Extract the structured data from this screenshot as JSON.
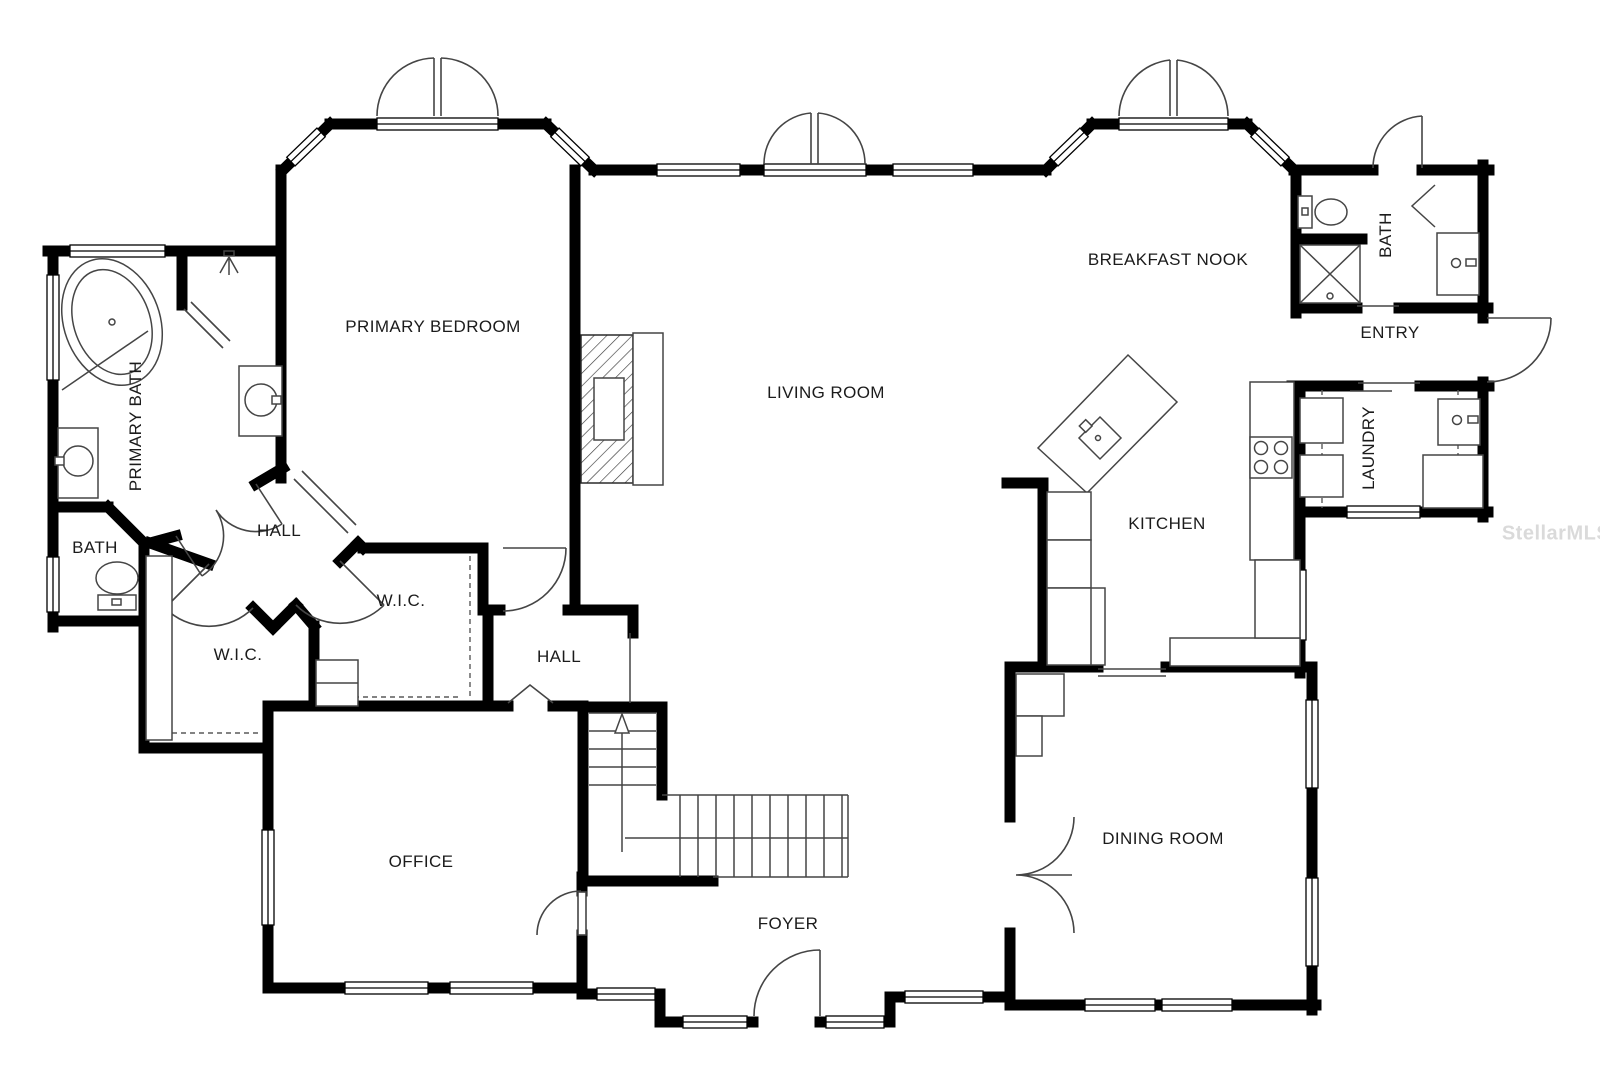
{
  "rooms": {
    "primary_bedroom": "PRIMARY BEDROOM",
    "primary_bath": "PRIMARY BATH",
    "bath_left": "BATH",
    "hall_main": "HALL",
    "wic_left": "W.I.C.",
    "wic_right": "W.I.C.",
    "hall_right": "HALL",
    "office": "OFFICE",
    "foyer": "FOYER",
    "living_room": "LIVING ROOM",
    "breakfast_nook": "BREAKFAST NOOK",
    "entry": "ENTRY",
    "bath_pool": "BATH",
    "laundry": "LAUNDRY",
    "kitchen": "KITCHEN",
    "dining_room": "DINING ROOM"
  },
  "watermark": "StellarMLS",
  "colors": {
    "wall": "#000000",
    "line": "#454545",
    "dash": "#5a5a5a",
    "background": "#ffffff",
    "watermark_text": "#dadada"
  }
}
